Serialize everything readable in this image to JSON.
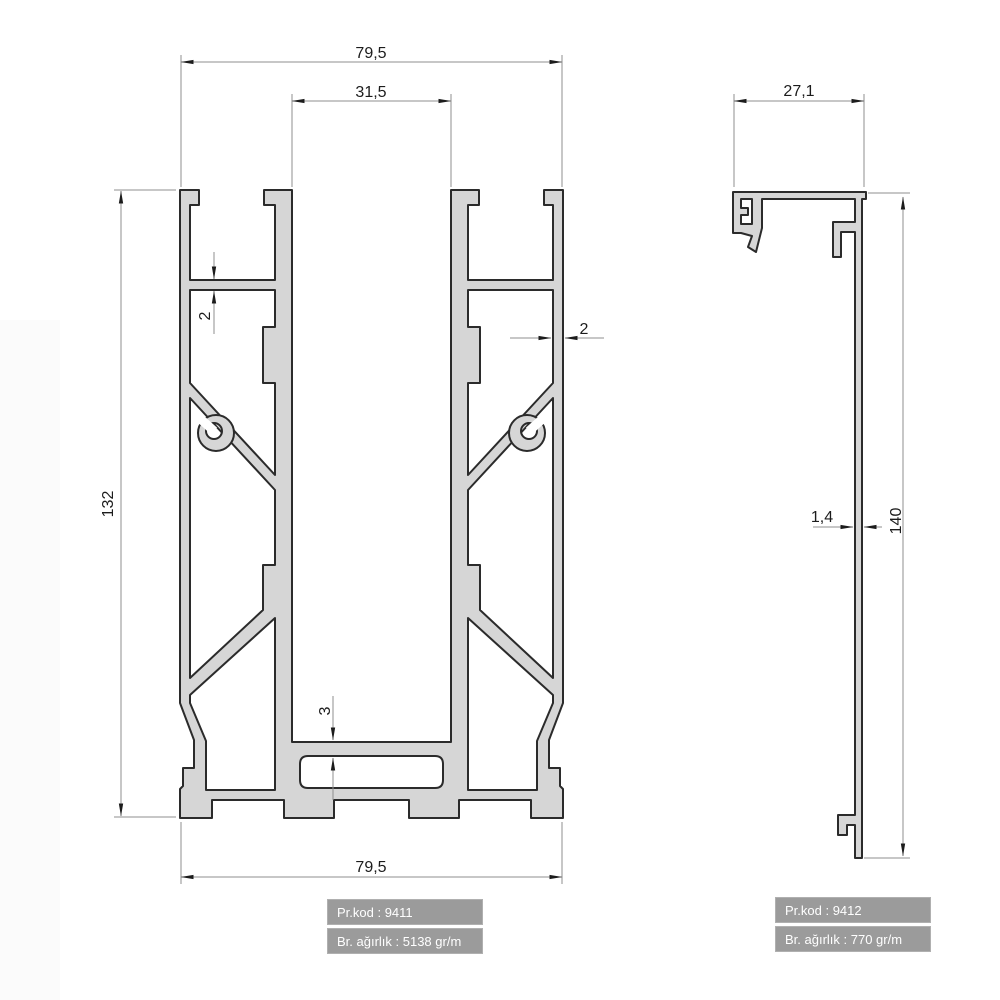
{
  "colors": {
    "profile_fill": "#d6d6d6",
    "profile_stroke": "#2b2b2b",
    "dim_line": "#8f8f8f",
    "dim_text": "#1c1c1c",
    "label_bg": "#9b9b9b",
    "label_text": "#ffffff"
  },
  "left_profile": {
    "dimensions": {
      "top_width": "79,5",
      "slot_width": "31,5",
      "height": "132",
      "web_thickness": "2",
      "wall_thickness": "2",
      "floor_thickness": "3",
      "bottom_width": "79,5"
    },
    "info": {
      "product_code": "Pr.kod : 9411",
      "unit_weight": "Br. ağırlık : 5138 gr/m"
    }
  },
  "right_profile": {
    "dimensions": {
      "top_width": "27,1",
      "wall_thickness": "1,4",
      "height": "140"
    },
    "info": {
      "product_code": "Pr.kod : 9412",
      "unit_weight": "Br. ağırlık : 770 gr/m"
    }
  }
}
